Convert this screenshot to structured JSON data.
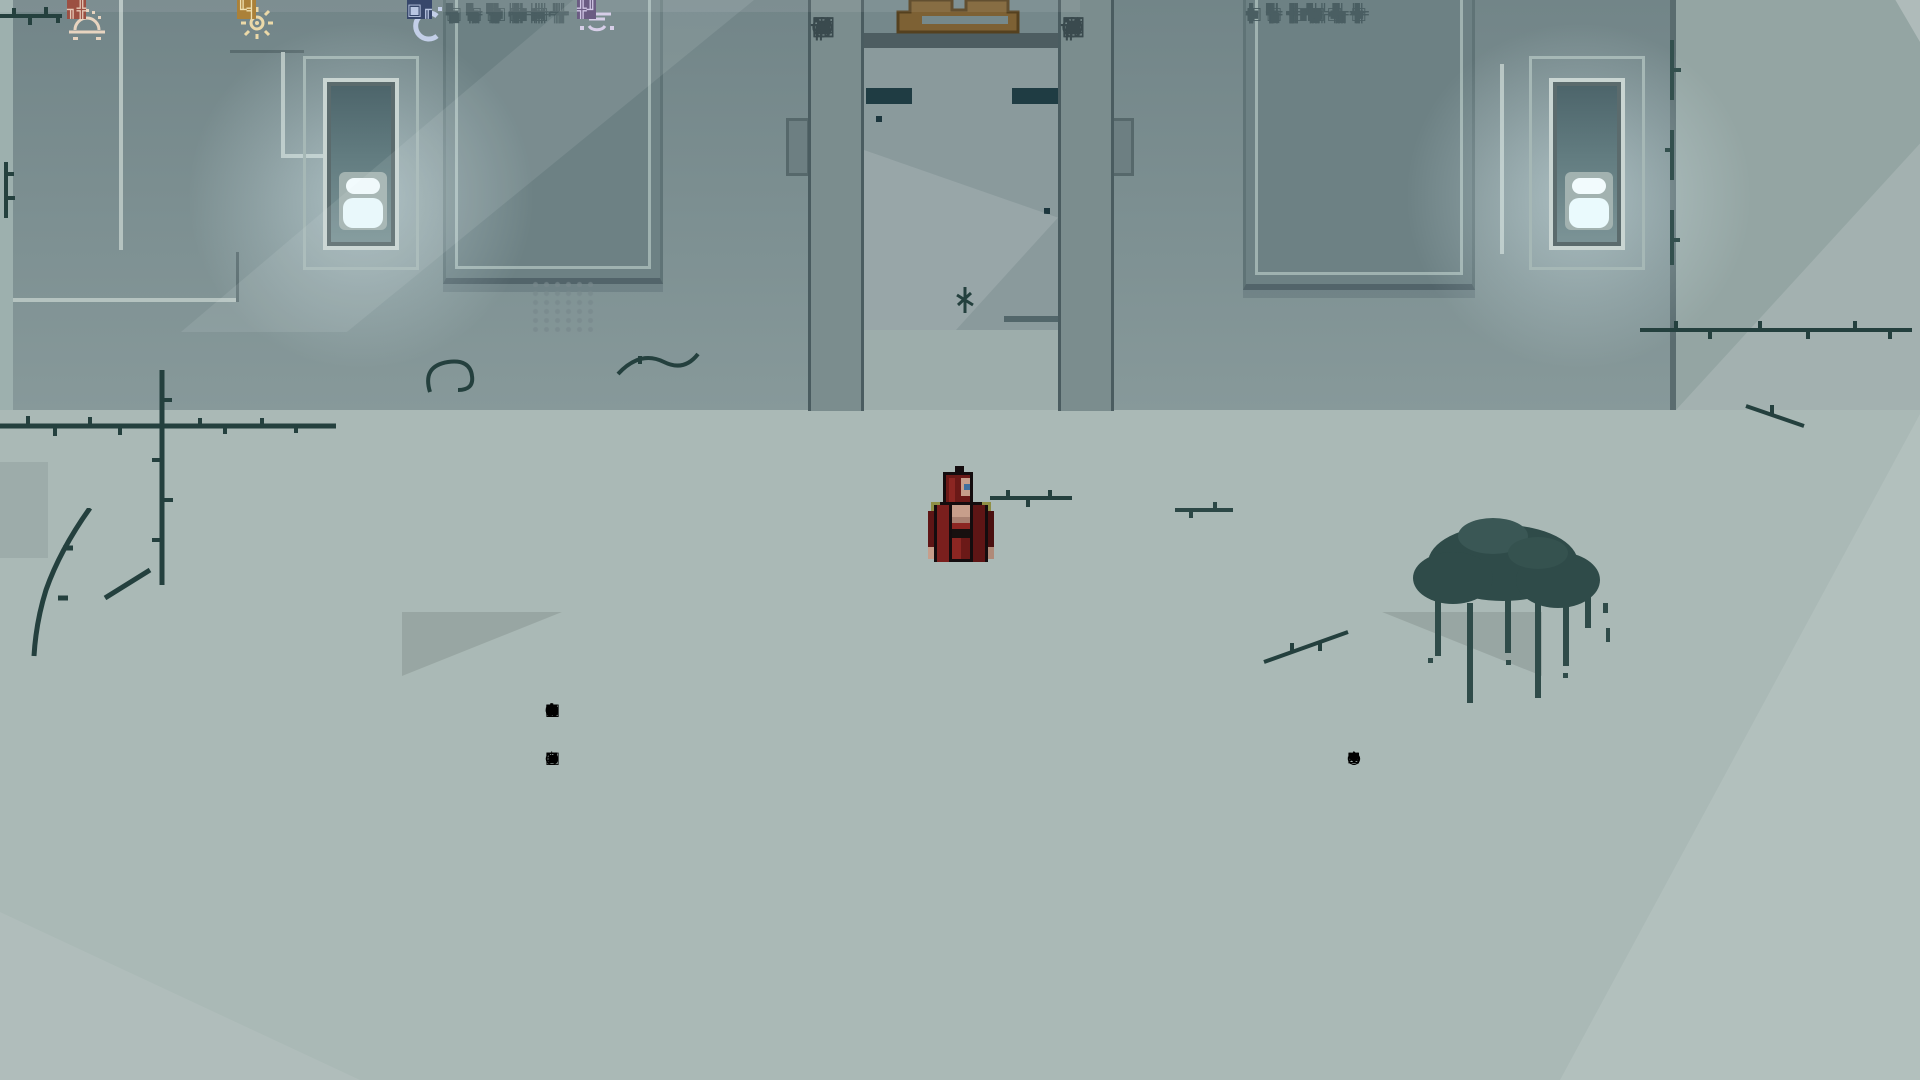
{
  "scene": {
    "title": "temple-entrance-hall"
  },
  "colors": {
    "wall": "#7d9092",
    "floor": "#aab9b6",
    "dark_accent": "#24403e",
    "lamp_glow": "#eafafd",
    "doorway_teal": "#2f5359",
    "gate_emblem_brown": "#7d6134",
    "statue_red": "#a3584a",
    "statue_gold": "#b68d41",
    "statue_blue": "#3c4e74",
    "statue_purple": "#64517e"
  },
  "tablets": {
    "left": {
      "rows": [
        "╬ ⌐ ▣ ╋ ┤ ╦",
        "╒ ▚ ╪ ╠ ◧ ║",
        "╠ ╫ ┼ ⌐ ╛ ╬",
        "▣ ╦ ╋ ◨ ╠ ═",
        "┤ ╬ ▚ ╪ ╒ ╩",
        "╋ ◧ ╦ ╫ ▣ ┼",
        "╬ ╛ ╠ ║ ╪ ⌐",
        "▚ ╒ ╬ ▣ ╦ ╫",
        "┼ ╠ ◨ ╋ ╬ ═",
        "╪ ▣ ╒ ┤ ╩ ╬"
      ]
    },
    "right": {
      "rows": [
        "╫ ╬ ╋ ▣ ╠ ┤",
        "◧ ╒ ╪ ╦ ▚ ║",
        "⌐ ╠ ╬ ┼ ╛ ╋",
        "╋ ▣ ◨ ╠ ╦ ═",
        "╬ ┤ ╪ ▚ ╒ ╩",
        "║ ╋ ╫ ╦ ▣ ┼",
        "╛ ╬ ╠ ◧ ╪ ⌐",
        "╒ ▚ ╬ ▣ ╫ ╦",
        "╠ ┼ ╋ ◨ ═ ╬",
        "▣ ╪ ┤ ╒ ╬ ╩",
        "╦ ╫ ║ ╋ ⌐ ▣"
      ]
    }
  },
  "pillars": {
    "left_glyphs": [
      "▣",
      "⊠",
      "╥",
      "◌",
      "▤",
      "▦",
      "▣",
      "✕",
      "◎"
    ],
    "right_glyphs": [
      "◎",
      "✕",
      "▣",
      "▦",
      "▤",
      "◌",
      "╥",
      "⊠",
      "▣"
    ]
  },
  "door_frame": {
    "top_tiles": [
      "◌",
      "✸",
      "⊞",
      "✳",
      "◎",
      "✕",
      "◌",
      "⊠",
      "✚",
      "⊗",
      "◉",
      "⊡",
      "❖",
      "✕",
      "▣",
      "▦",
      "✳",
      "◌",
      "⊞",
      "✸",
      "◎",
      "⊠",
      "✱",
      "◍",
      "✳"
    ],
    "left_tiles": [
      "◌",
      "◎",
      "▣",
      "✕",
      "◌",
      "⊞",
      "✳",
      "◎",
      "⊠"
    ],
    "right_tiles": [
      "❖",
      "◌",
      "✳",
      "⊡",
      "◎",
      "✕",
      "⊞",
      "◌",
      "✸"
    ]
  },
  "statues": [
    {
      "symbol": "sunrise-icon",
      "shape": "octagon",
      "emblem_color": "#a3584a",
      "plaque_text": "╖╬",
      "plaque_color": "#9c4f42",
      "text_color": "#e6c9b8"
    },
    {
      "symbol": "sun-icon",
      "shape": "octagon",
      "emblem_color": "#b68d41",
      "plaque_text": "╙╡",
      "plaque_color": "#ab8139",
      "text_color": "#efe0b0"
    },
    {
      "symbol": "moon-icon",
      "shape": "banner",
      "emblem_color": "#3c4e74",
      "plaque_text": "▣╓",
      "plaque_color": "#37476b",
      "text_color": "#b9c6e2"
    },
    {
      "symbol": "sleep-icon",
      "shape": "banner",
      "emblem_color": "#64517e",
      "plaque_text": "╬╜",
      "plaque_color": "#5d4b77",
      "text_color": "#cfc3e6"
    }
  ]
}
